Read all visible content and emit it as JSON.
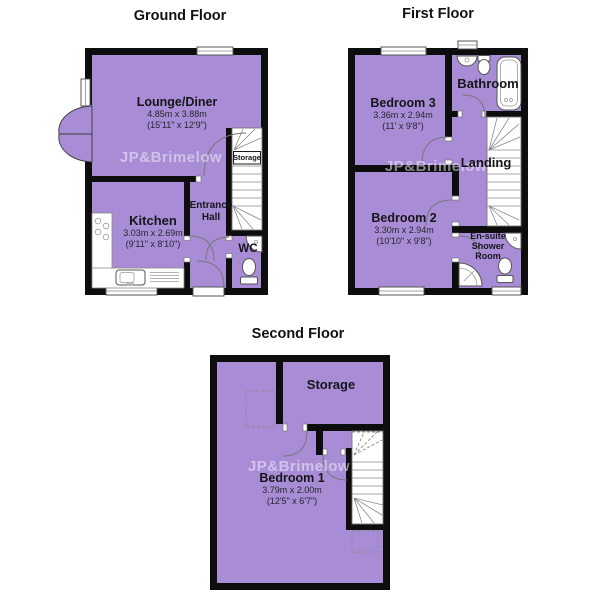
{
  "watermark": "JP&Brimelow",
  "colors": {
    "room_fill": "#a88dd6",
    "wall": "#0d0d0d",
    "fixture": "#ffffff",
    "text": "#111111"
  },
  "floors": {
    "ground": {
      "title": "Ground Floor",
      "rooms": {
        "lounge": {
          "name": "Lounge/Diner",
          "metric": "4.85m x 3.88m",
          "imperial": "(15'11\" x 12'9\")"
        },
        "kitchen": {
          "name": "Kitchen",
          "metric": "3.03m x 2.69m",
          "imperial": "(9'11\" x 8'10\")"
        },
        "hall": {
          "name": "Entrance Hall"
        },
        "wc": {
          "name": "WC"
        },
        "storage": {
          "name": "Storage"
        }
      }
    },
    "first": {
      "title": "First Floor",
      "rooms": {
        "bedroom3": {
          "name": "Bedroom 3",
          "metric": "3.36m x 2.94m",
          "imperial": "(11' x 9'8\")"
        },
        "bathroom": {
          "name": "Bathroom"
        },
        "landing": {
          "name": "Landing"
        },
        "bedroom2": {
          "name": "Bedroom 2",
          "metric": "3.30m x 2.94m",
          "imperial": "(10'10\" x 9'8\")"
        },
        "ensuite": {
          "name": "En-suite Shower Room"
        }
      }
    },
    "second": {
      "title": "Second Floor",
      "rooms": {
        "storage": {
          "name": "Storage"
        },
        "bedroom1": {
          "name": "Bedroom 1",
          "metric": "3.79m x 2.00m",
          "imperial": "(12'5\" x 6'7\")"
        }
      }
    }
  }
}
